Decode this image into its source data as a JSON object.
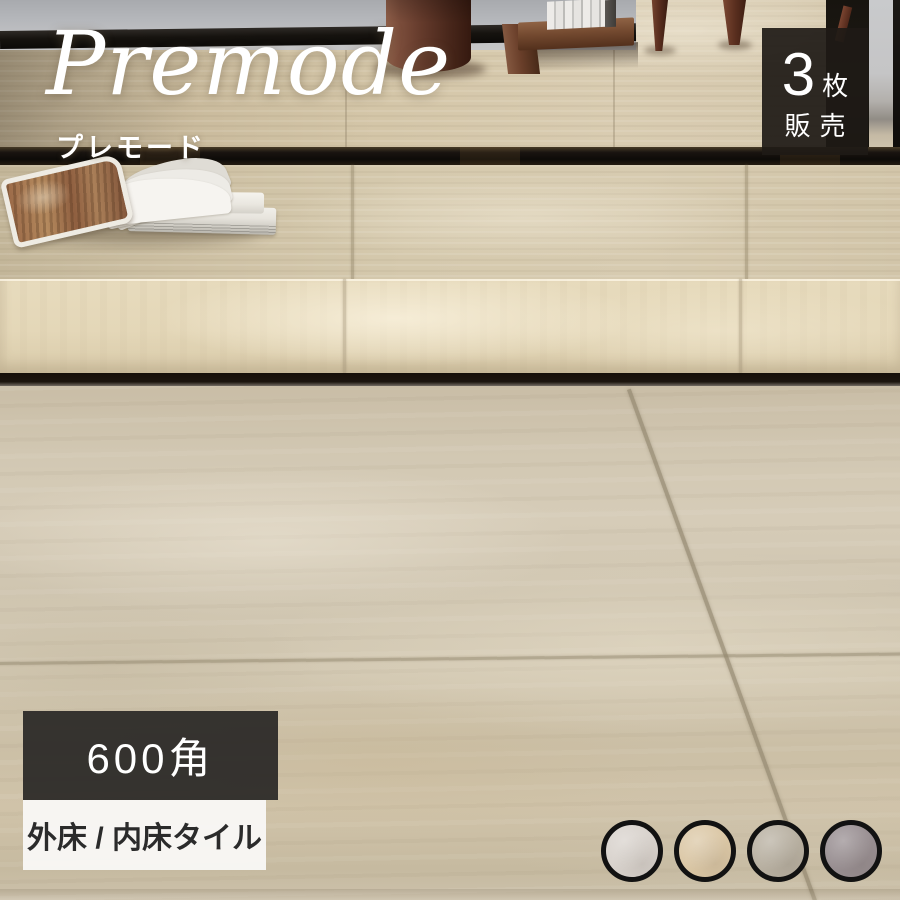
{
  "product": {
    "brand_en": "Premode",
    "brand_jp": "プレモード",
    "sale_badge": {
      "count": "3",
      "unit": "枚",
      "label": "販売"
    },
    "size_badge": "600角",
    "type_badge": "外床 / 内床タイル"
  },
  "swatches": [
    {
      "name": "white",
      "color": "#d8d2cc"
    },
    {
      "name": "beige",
      "color": "#dbc7a5"
    },
    {
      "name": "greige",
      "color": "#b8b0a1"
    },
    {
      "name": "gray",
      "color": "#988e91"
    }
  ],
  "colors": {
    "sale_badge_bg": "#1e1a16",
    "size_badge_bg": "#2c2927",
    "type_badge_bg": "#f8f7f5",
    "type_badge_text": "#2b2b2b",
    "logo_text": "#ffffff",
    "floor_base": "#cfc4ae",
    "swatch_ring": "#121212"
  }
}
